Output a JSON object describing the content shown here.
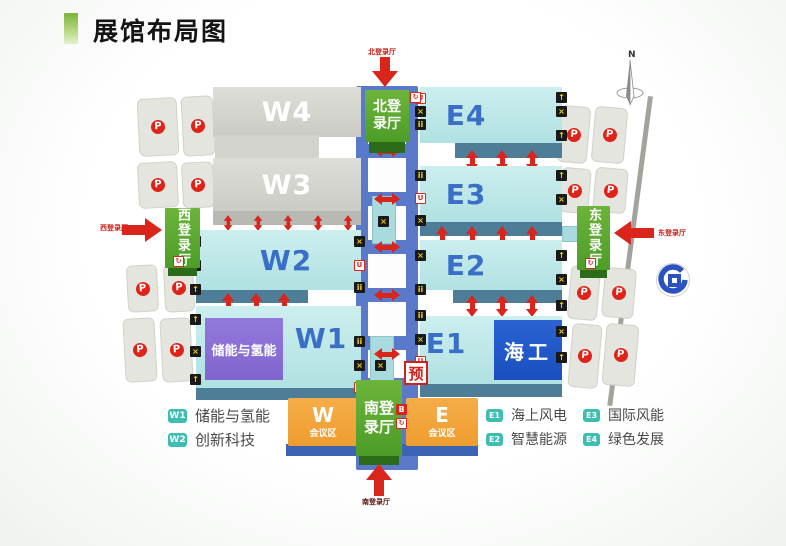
{
  "title": "展馆布局图",
  "compass_label": "N",
  "pre_registration_label": "预",
  "parking_label": "P",
  "halls": {
    "w1": "W1",
    "w2": "W2",
    "w3": "W3",
    "w4": "W4",
    "e1": "E1",
    "e2": "E2",
    "e3": "E3",
    "e4": "E4"
  },
  "zones": {
    "w1_theme": "储能与氢能",
    "e1_theme": "海工"
  },
  "entrances": {
    "north": {
      "name": "北登录厅",
      "arrow_label": "北登录厅"
    },
    "south": {
      "name": "南登录厅",
      "arrow_label": "南登录厅"
    },
    "west": {
      "name": "西登录厅",
      "arrow_label": "西登录厅"
    },
    "east": {
      "name": "东登录厅",
      "arrow_label": "东登录厅"
    }
  },
  "conference": {
    "west": {
      "letter": "W",
      "area_label": "会议区"
    },
    "east": {
      "letter": "E",
      "area_label": "会议区"
    }
  },
  "legend": {
    "west": [
      {
        "badge": "W1",
        "label": "储能与氢能"
      },
      {
        "badge": "W2",
        "label": "创新科技"
      }
    ],
    "east": [
      {
        "badge": "E1",
        "label": "海上风电"
      },
      {
        "badge": "E2",
        "label": "智慧能源"
      },
      {
        "badge": "E3",
        "label": "国际风能"
      },
      {
        "badge": "E4",
        "label": "绿色发展"
      }
    ]
  },
  "icons": {
    "cross": "×",
    "escalator": "↑",
    "restroom": "ii",
    "first_aid": "U",
    "business": "B",
    "registration": "↻"
  },
  "colors": {
    "accent_red": "#d9251c",
    "hall_cyan": "#bfe7e9",
    "hall_gray": "#d6d6d1",
    "entrance_green": "#5aa82e",
    "conference_orange": "#f3a53f",
    "corridor_blue": "#5b79c9",
    "theme_purple": "#8a6fd8",
    "theme_blue": "#1d56c6",
    "legend_teal": "#3ebeb2"
  }
}
